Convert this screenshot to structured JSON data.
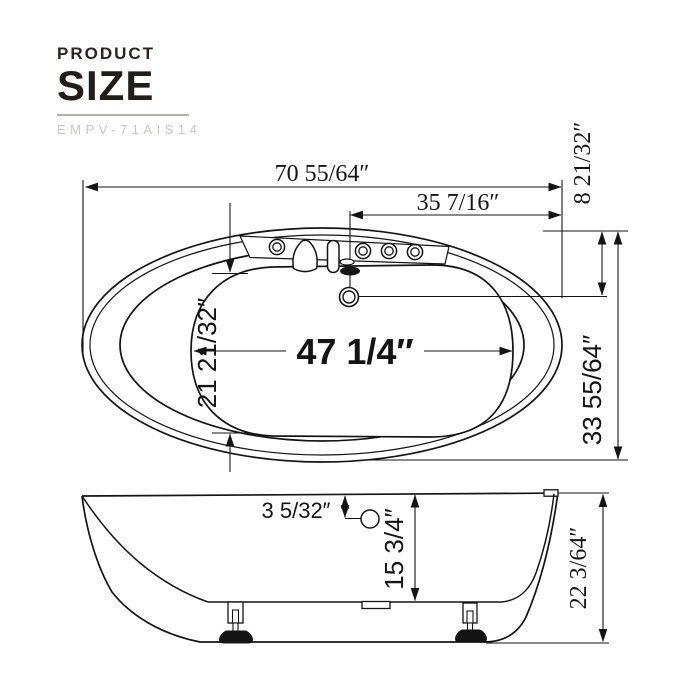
{
  "header": {
    "product_label": "PRODUCT",
    "size_label": "SIZE",
    "model": "EMPV-71AIS14"
  },
  "top_view": {
    "overall_length": "70 55/64″",
    "drain_offset_x": "35 7/16″",
    "drain_offset_y": "8 21/32″",
    "basin_length": "47 1/4″",
    "basin_width": "21 21/32″",
    "overall_width": "33 55/64″"
  },
  "side_view": {
    "overflow_drop": "3 5/32″",
    "inner_depth": "15 3/4″",
    "overall_height": "22 3/64″"
  },
  "colors": {
    "line": "#141414",
    "logo_dark": "#231d1a",
    "model_gray": "#c9c5c2"
  }
}
